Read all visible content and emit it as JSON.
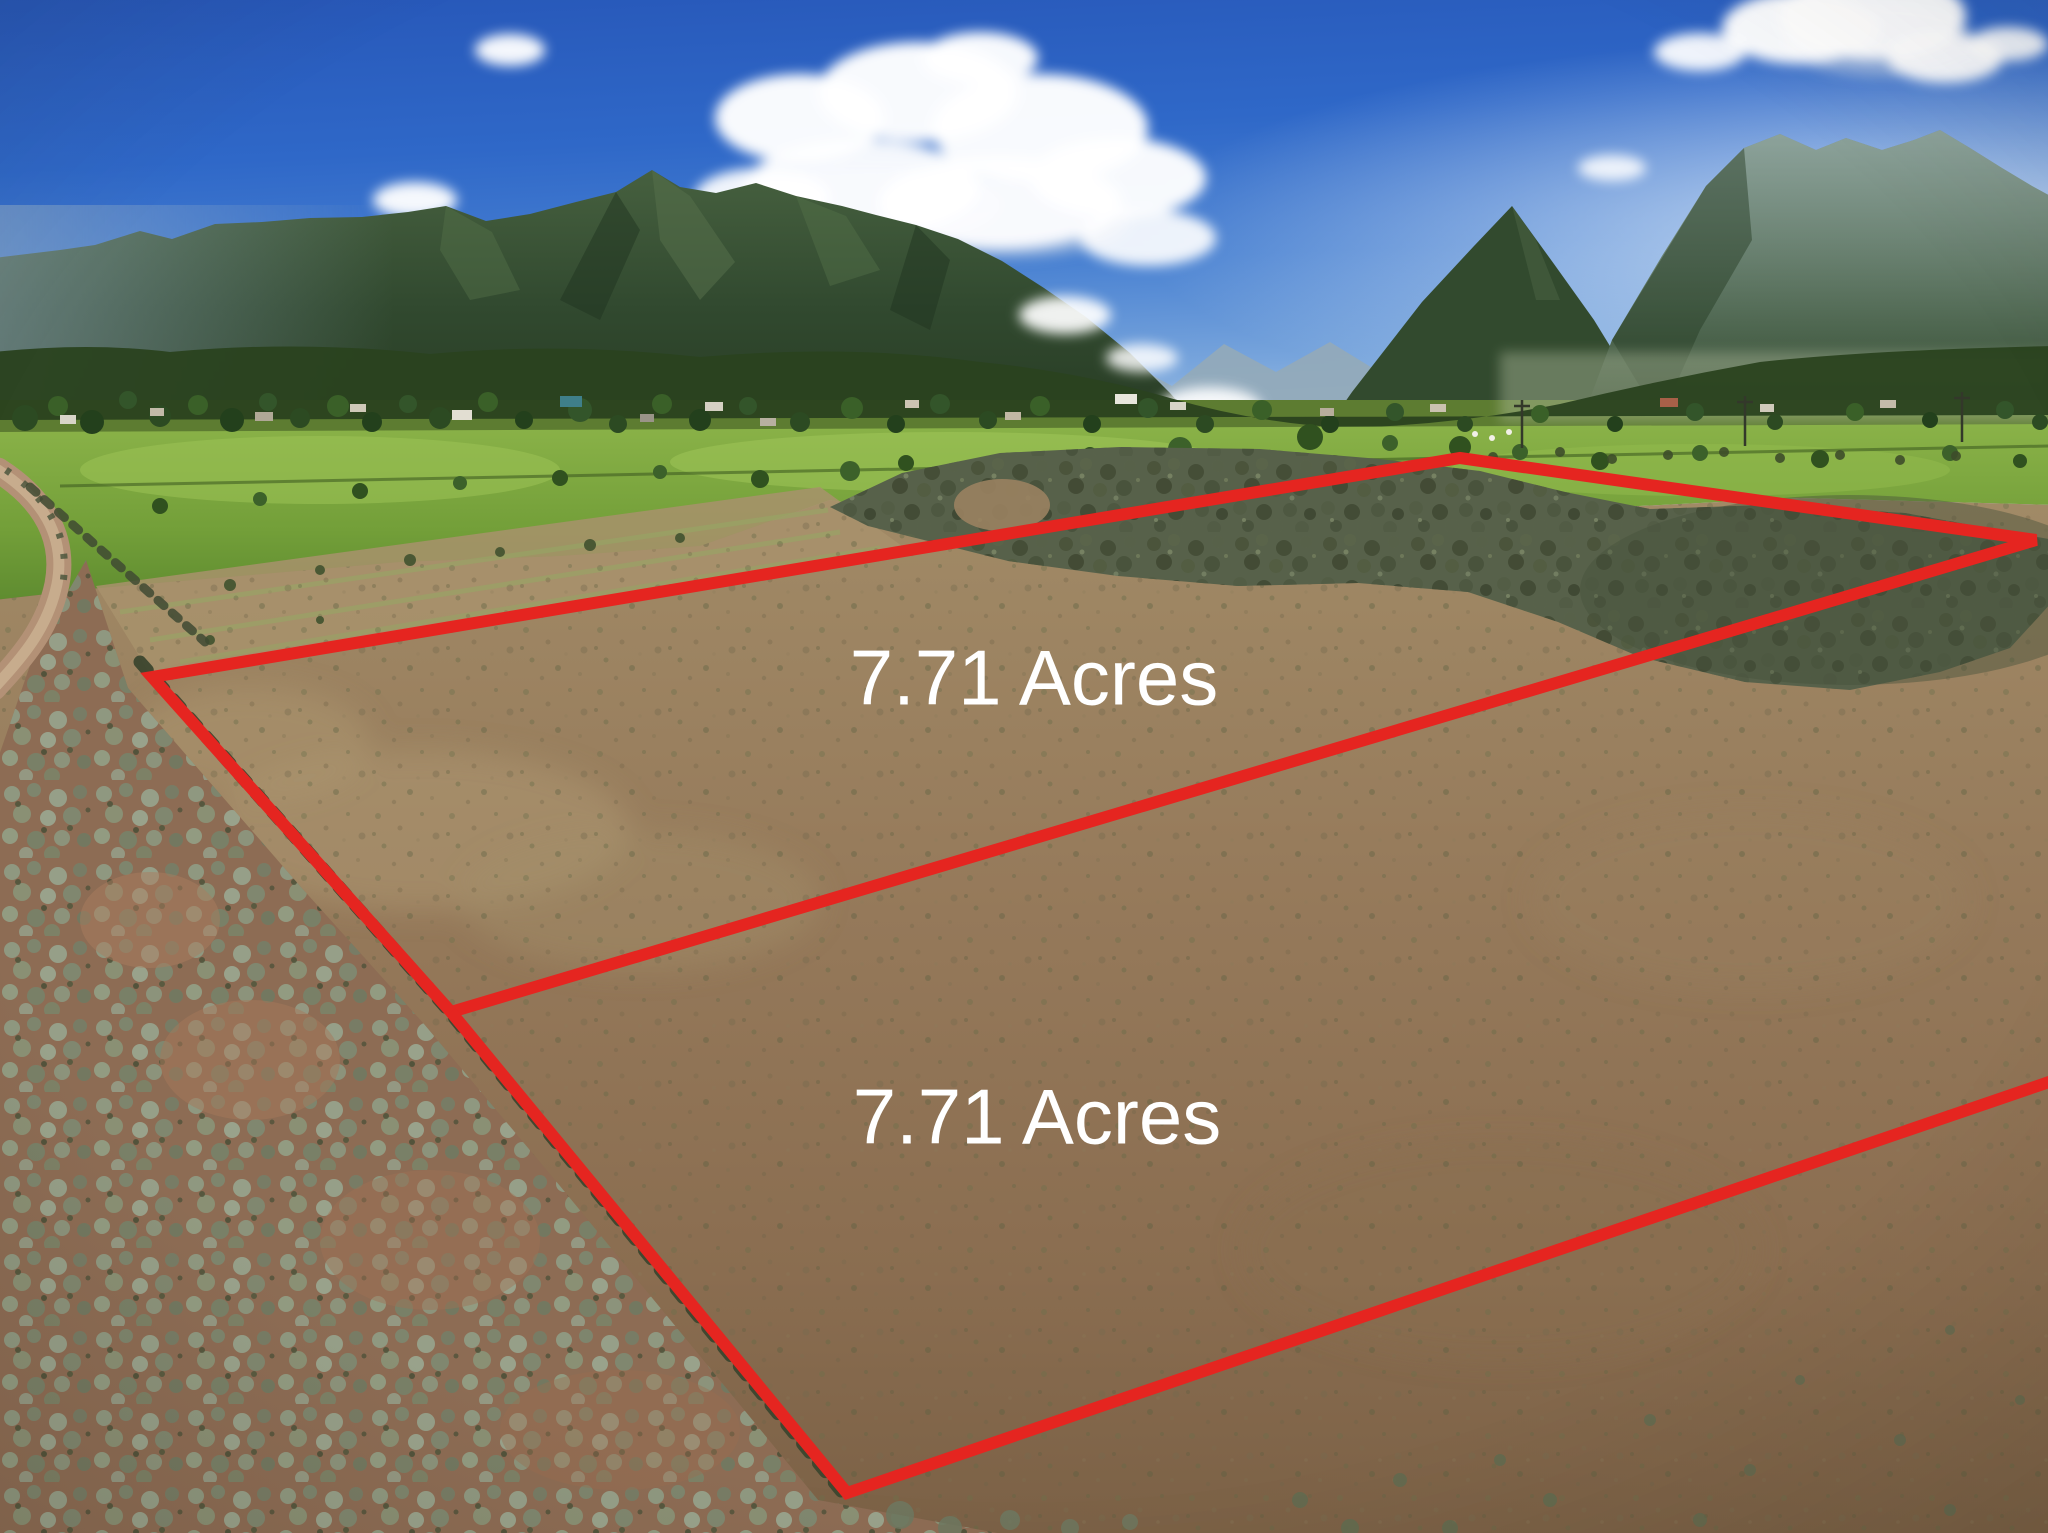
{
  "photo": {
    "parcels": [
      {
        "label": "7.71 Acres"
      },
      {
        "label": "7.71 Acres"
      }
    ],
    "overlay": {
      "boundary_color": "#e52520",
      "label_color": "#ffffff"
    },
    "palette": {
      "sky_top": "#2757b8",
      "sky_horizon": "#cfe2f0",
      "mountain_green": "#31492f",
      "pasture_green": "#739f39",
      "dirt_brown": "#95795a",
      "sagebrush_gray_green": "#8f9a82",
      "cloud_white": "#ffffff"
    }
  }
}
